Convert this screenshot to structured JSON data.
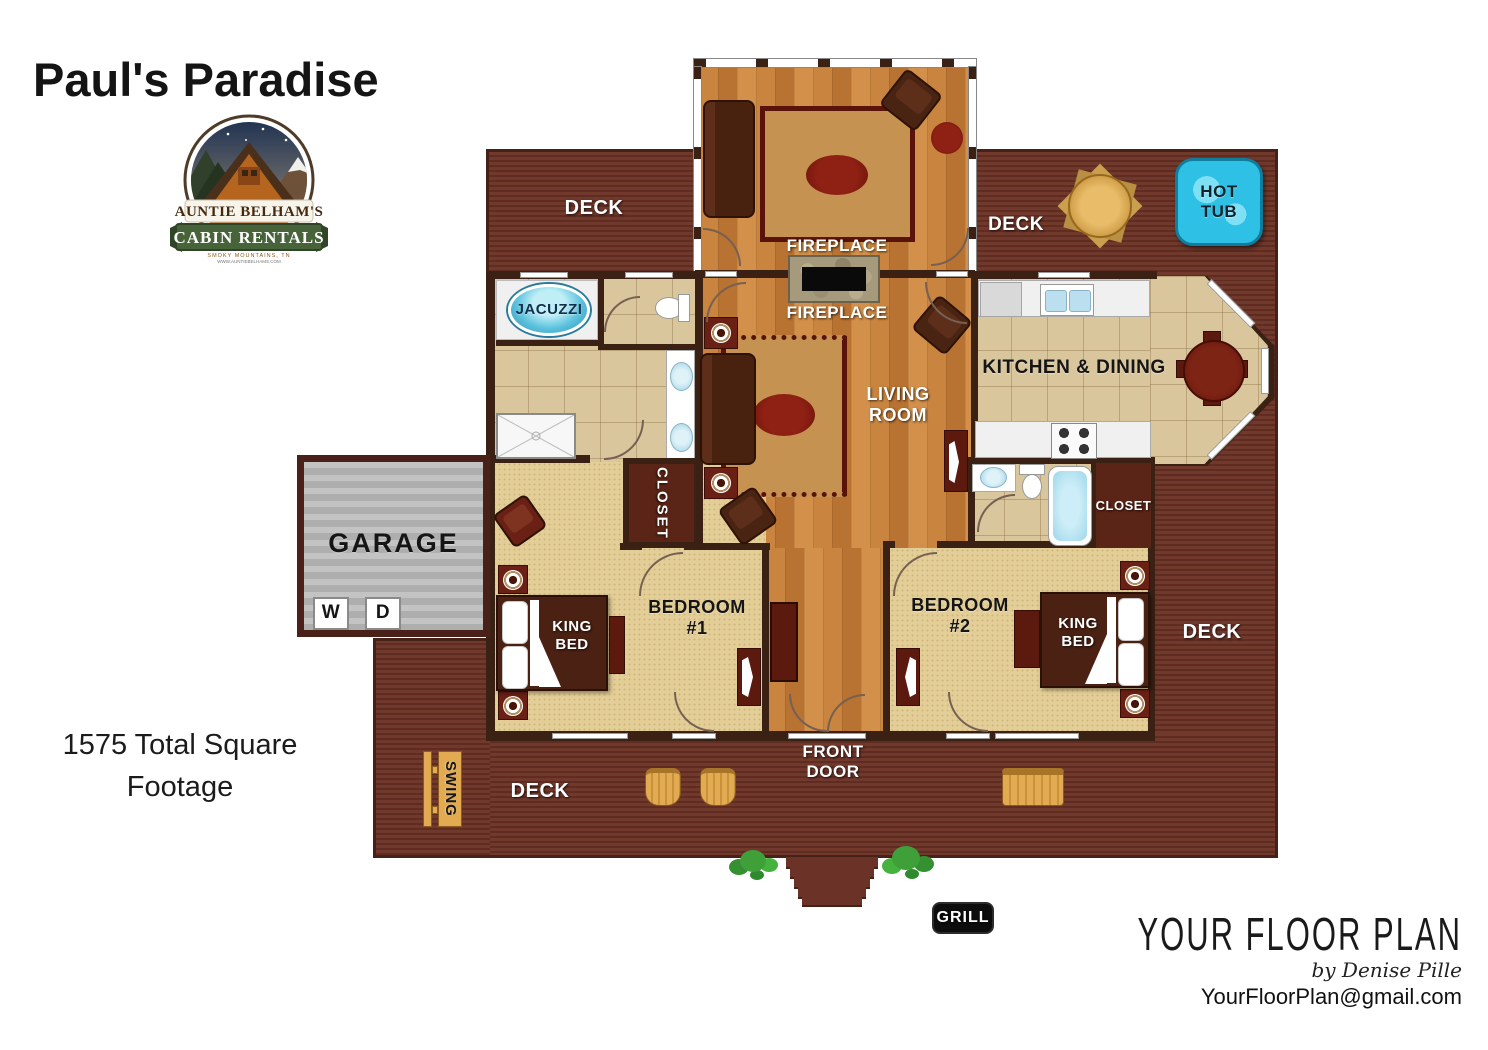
{
  "header": {
    "title": "Paul's Paradise"
  },
  "logo": {
    "banner": "AUNTIE BELHAM'S",
    "ribbon": "CABIN RENTALS",
    "tagline": "SMOKY MOUNTAINS, TN",
    "website": "WWW.AUNTIEBELHAMS.COM"
  },
  "labels": {
    "deck_upper_left": "DECK",
    "deck_upper_right": "DECK",
    "deck_right": "DECK",
    "deck_front": "DECK",
    "hot_tub": "HOT TUB",
    "fireplace_upper": "FIREPLACE",
    "fireplace_lower": "FIREPLACE",
    "jacuzzi": "JACUZZI",
    "kitchen_dining": "KITCHEN & DINING",
    "living_room": "LIVING ROOM",
    "closet_1": "CLOSET",
    "closet_2": "CLOSET",
    "garage": "GARAGE",
    "washer": "W",
    "dryer": "D",
    "bedroom_1": "BEDROOM #1",
    "bedroom_2": "BEDROOM #2",
    "king_bed_1": "KING BED",
    "king_bed_2": "KING BED",
    "front_door": "FRONT DOOR",
    "swing": "SWING",
    "grill": "GRILL"
  },
  "footage": {
    "text": "1575 Total Square Footage"
  },
  "branding": {
    "name": "YOUR FLOOR PLAN",
    "byline": "by Denise Pille",
    "email": "YourFloorPlan@gmail.com"
  },
  "colors": {
    "deck": "#6E3529",
    "wall": "#3A2114",
    "wood_floor": "#C5803C",
    "tile": "#D8C39A",
    "carpet": "#E2CD96",
    "hot_tub_blue": "#2FC0E6",
    "garage_gray": "#B8B8B8",
    "furniture_red": "#5C190E",
    "logo_green": "#47633A",
    "logo_orange": "#C26A28"
  }
}
